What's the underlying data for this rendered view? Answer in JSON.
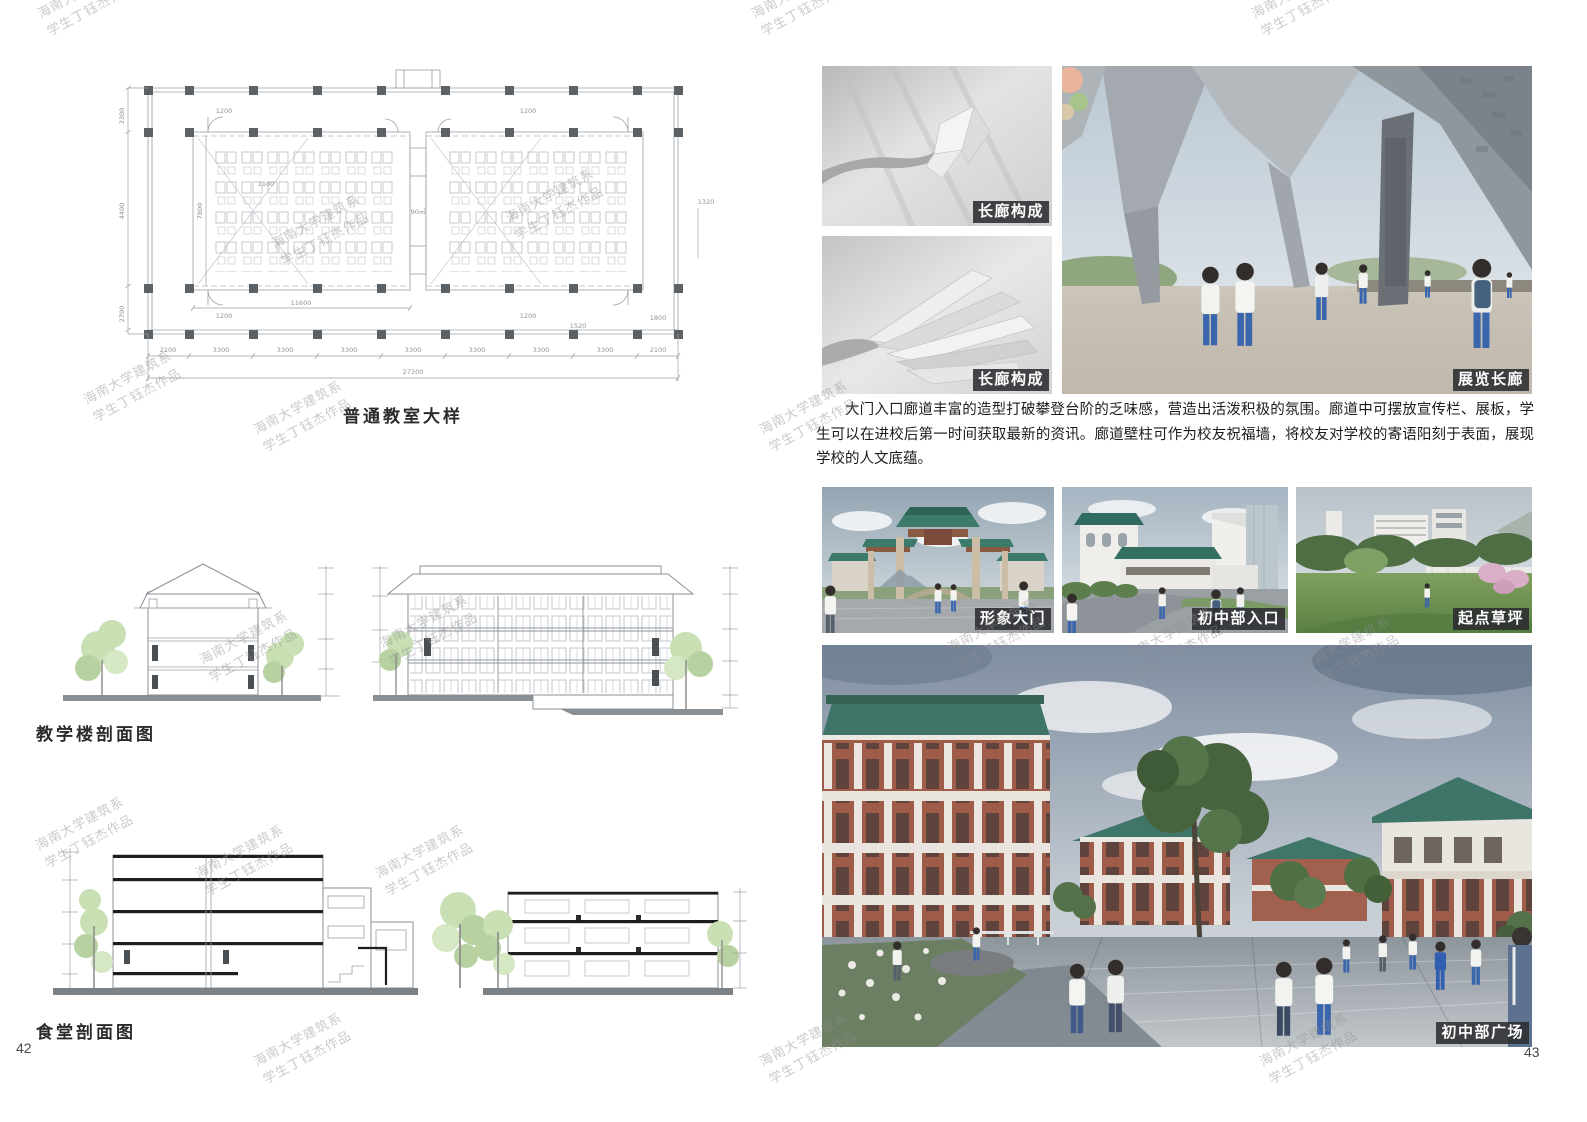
{
  "watermarks": {
    "line1": "海南大学建筑系",
    "line2": "学生丁钰杰作品",
    "positions": [
      {
        "x": 34,
        "y": 6
      },
      {
        "x": 748,
        "y": 6
      },
      {
        "x": 1248,
        "y": 6
      },
      {
        "x": 80,
        "y": 392
      },
      {
        "x": 250,
        "y": 422
      },
      {
        "x": 756,
        "y": 422
      },
      {
        "x": 268,
        "y": 236
      },
      {
        "x": 502,
        "y": 210
      },
      {
        "x": 196,
        "y": 652
      },
      {
        "x": 376,
        "y": 636
      },
      {
        "x": 944,
        "y": 640
      },
      {
        "x": 1122,
        "y": 648
      },
      {
        "x": 1298,
        "y": 658
      },
      {
        "x": 32,
        "y": 838
      },
      {
        "x": 192,
        "y": 866
      },
      {
        "x": 372,
        "y": 866
      },
      {
        "x": 250,
        "y": 1054
      },
      {
        "x": 756,
        "y": 1054
      },
      {
        "x": 1256,
        "y": 1054
      }
    ]
  },
  "left_page": {
    "page_number": "42",
    "plan": {
      "title": "普通教室大样",
      "area_label": "90㎡",
      "dim_total": "27300",
      "dim_inner": "11600",
      "dim_door": "1200",
      "dim_door2": "1200",
      "dim_door3": "1200",
      "dim_door4": "1200",
      "dim_1100": "1100",
      "dim_1320": "1320",
      "dim_1800": "1800",
      "dim_1520": "1520",
      "dim_7800": "7800",
      "dims_bottom": [
        "2100",
        "3300",
        "3300",
        "3300",
        "3300",
        "3300",
        "3300",
        "3300",
        "2100"
      ],
      "dims_left": [
        "2300",
        "4400",
        "2700"
      ]
    },
    "sections": {
      "teaching_label": "教学楼剖面图",
      "canteen_label": "食堂剖面图"
    }
  },
  "right_page": {
    "page_number": "43",
    "paragraph": "大门入口廊道丰富的造型打破攀登台阶的乏味感，营造出活泼积极的氛围。廊道中可摆放宣传栏、展板，学生可以在进校后第一时间获取最新的资讯。廊道壁柱可作为校友祝福墙，将校友对学校的寄语阳刻于表面，展现学校的人文底蕴。",
    "photos": {
      "corridor_study_1": {
        "caption": "长廊构成"
      },
      "corridor_study_2": {
        "caption": "长廊构成"
      },
      "exhibition_corridor": {
        "caption": "展览长廊"
      },
      "image_gate": {
        "caption": "形象大门"
      },
      "junior_entrance": {
        "caption": "初中部入口"
      },
      "starting_lawn": {
        "caption": "起点草坪"
      },
      "junior_plaza": {
        "caption": "初中部广场"
      }
    }
  }
}
